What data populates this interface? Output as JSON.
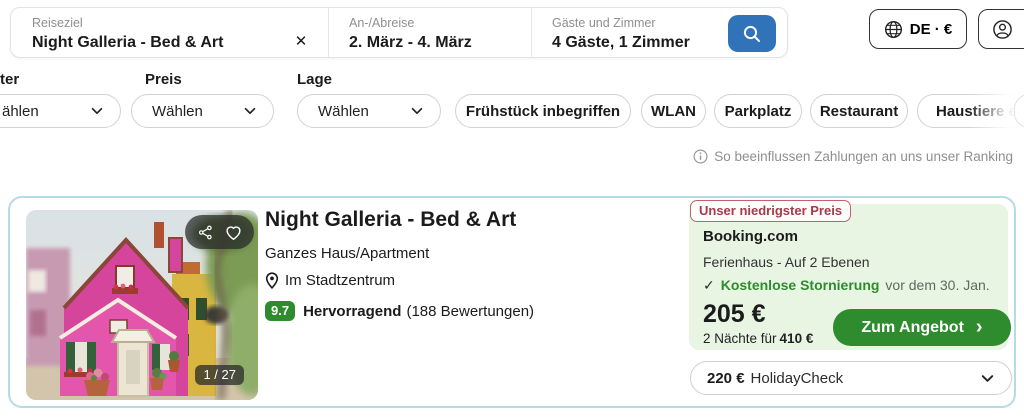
{
  "colors": {
    "accent_blue": "#3173b9",
    "green": "#2e8b2e",
    "light_green_bg": "#e8f5e3",
    "card_border": "#b6dbe8",
    "badge_red": "#a63a4b"
  },
  "search": {
    "destination": {
      "label": "Reiseziel",
      "value": "Night Galleria - Bed & Art",
      "clear_icon": "✕"
    },
    "dates": {
      "label": "An-/Abreise",
      "value": "2. März - 4. März"
    },
    "guests": {
      "label": "Gäste und Zimmer",
      "value": "4 Gäste, 1 Zimmer"
    }
  },
  "header_actions": {
    "locale": "DE · €"
  },
  "filters": {
    "dropdowns": [
      {
        "label": "ter",
        "value": "ählen"
      },
      {
        "label": "Preis",
        "value": "Wählen"
      },
      {
        "label": "Lage",
        "value": "Wählen"
      }
    ],
    "amenities": [
      "Frühstück inbegriffen",
      "WLAN",
      "Parkplatz",
      "Restaurant",
      "Haustiere e"
    ]
  },
  "ranking_note": "So beeinflussen Zahlungen an uns unser Ranking",
  "listing": {
    "image_counter": "1 / 27",
    "title": "Night Galleria - Bed & Art",
    "type": "Ganzes Haus/Apartment",
    "location": "Im Stadtzentrum",
    "rating": {
      "score": "9.7",
      "label": "Hervorragend",
      "reviews": "(188 Bewertungen)"
    },
    "best_offer": {
      "badge": "Unser niedrigster Preis",
      "provider": "Booking.com",
      "room": "Ferienhaus - Auf 2 Ebenen",
      "check_icon": "✓",
      "cancellation_bold": "Kostenlose Stornierung",
      "cancellation_rest": "vor dem 30. Jan.",
      "price": "205 €",
      "total_prefix": "2 Nächte für",
      "total_price": "410 €",
      "cta": "Zum Angebot",
      "cta_chevron": "›"
    },
    "alt_offer": {
      "price": "220 €",
      "provider": "HolidayCheck"
    }
  }
}
